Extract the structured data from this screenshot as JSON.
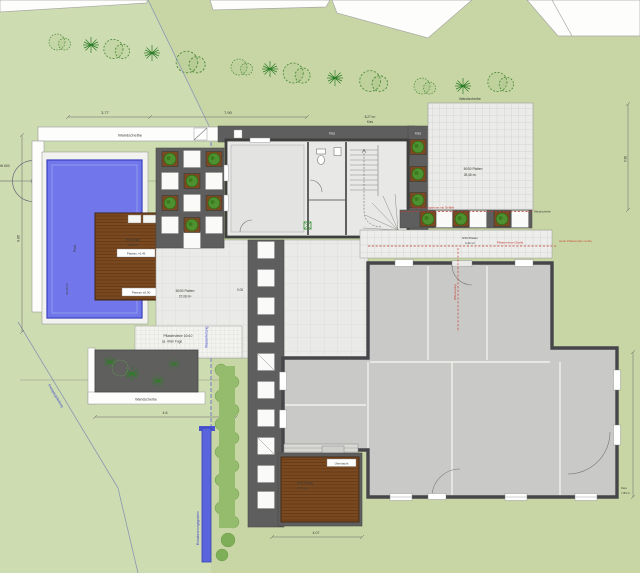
{
  "labels": {
    "wandscheibe": "Wandscheibe",
    "schacht": "Schacht DN 600",
    "pool": "Pool",
    "pool_area": "32,50 m²",
    "holzbelag": "Holzbelag",
    "laerche": "Lärche",
    "plateau_upper": "Plateau +0,45",
    "plateau_lower": "Plateau ±0,00",
    "kies": "Kies",
    "kies_area": "8,27 m²",
    "platten5050": "50/50 Platten",
    "patio_area": "28,46 m²",
    "terrace_area": "37,08 m²",
    "platten540": "5/40 Platten",
    "walkway_area": "4,32 m²",
    "pavers": "Pflastersteine 10x10",
    "pavers_joint": "ca. 4mm Fuge",
    "holz_belag_s": "Holz-Belag",
    "deck_s_area": "17,5 m²",
    "ueberdacht": "Überdacht",
    "level_zero": "0.00",
    "kies_len": "7,84 m",
    "entwaesserungsgraben": "Entwässerungsgraben",
    "wasserleitung": "Wasserleitung",
    "freispiegelleitung": "Freispiegelleitung",
    "red_band": "Entwässerungsrinne mit Gefälle",
    "red_rinne": "Pflasterrinne (Stahl)",
    "red_hinweis": "siehe Pflasterplan rechts",
    "red_rw": "RW-Leitung"
  },
  "dims": {
    "a": "3.77",
    "b": "7.90",
    "left": "9.85",
    "bed": "4.6",
    "deck": "4.07",
    "patio": "5.15",
    "patio_r": "5.60"
  },
  "colors": {
    "lawn": "#cedcb2",
    "lawn_dark": "#c2d29c",
    "pool_blue": "#7177ea",
    "deck_brown": "#7b4a21",
    "paving_dark": "#5e5e5e",
    "wall_gray": "#46464a",
    "annotation_red": "#c23b2e",
    "utility_blue": "#3a43c8"
  }
}
